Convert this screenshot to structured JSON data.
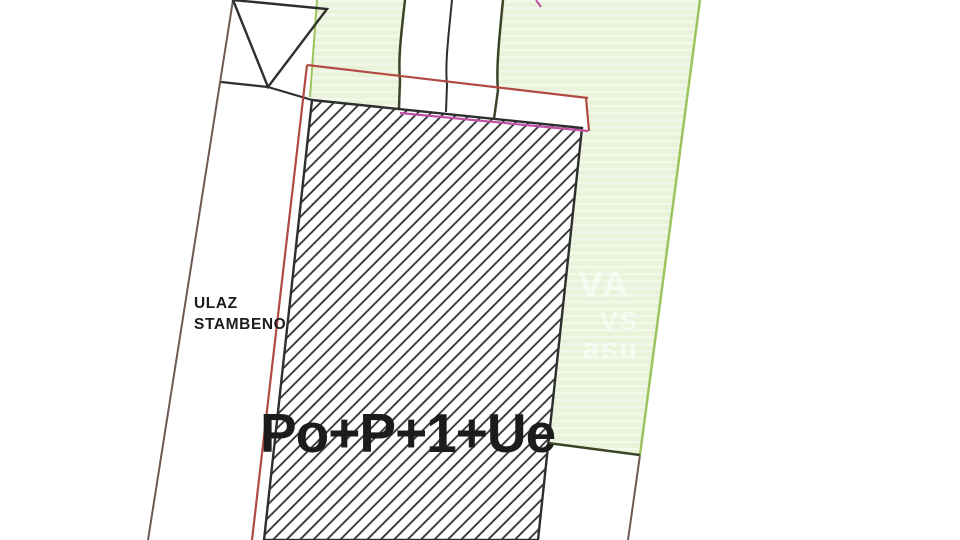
{
  "plan": {
    "kind": "cadastral-site-plan",
    "labels": {
      "building_designation": "Po+P+1+Ue",
      "entrance_line1": "ULAZ",
      "entrance_line2": "STAMBENO"
    },
    "watermark": {
      "row1": "VA",
      "row2": "VS",
      "row3": "asu"
    }
  },
  "colors": {
    "green_fill": "#e9f3da",
    "green_fill_stripe": "#f3f9ea",
    "green_border": "#9cc45e",
    "dark_green_edge": "#3a4527",
    "red_envelope": "#b04a42",
    "boundary_brown": "#6d5a52",
    "magenta": "#c04fa5",
    "line_black": "#2e2e2e",
    "text_black": "#1c1c1c",
    "watermark_white": "#ffffff"
  }
}
